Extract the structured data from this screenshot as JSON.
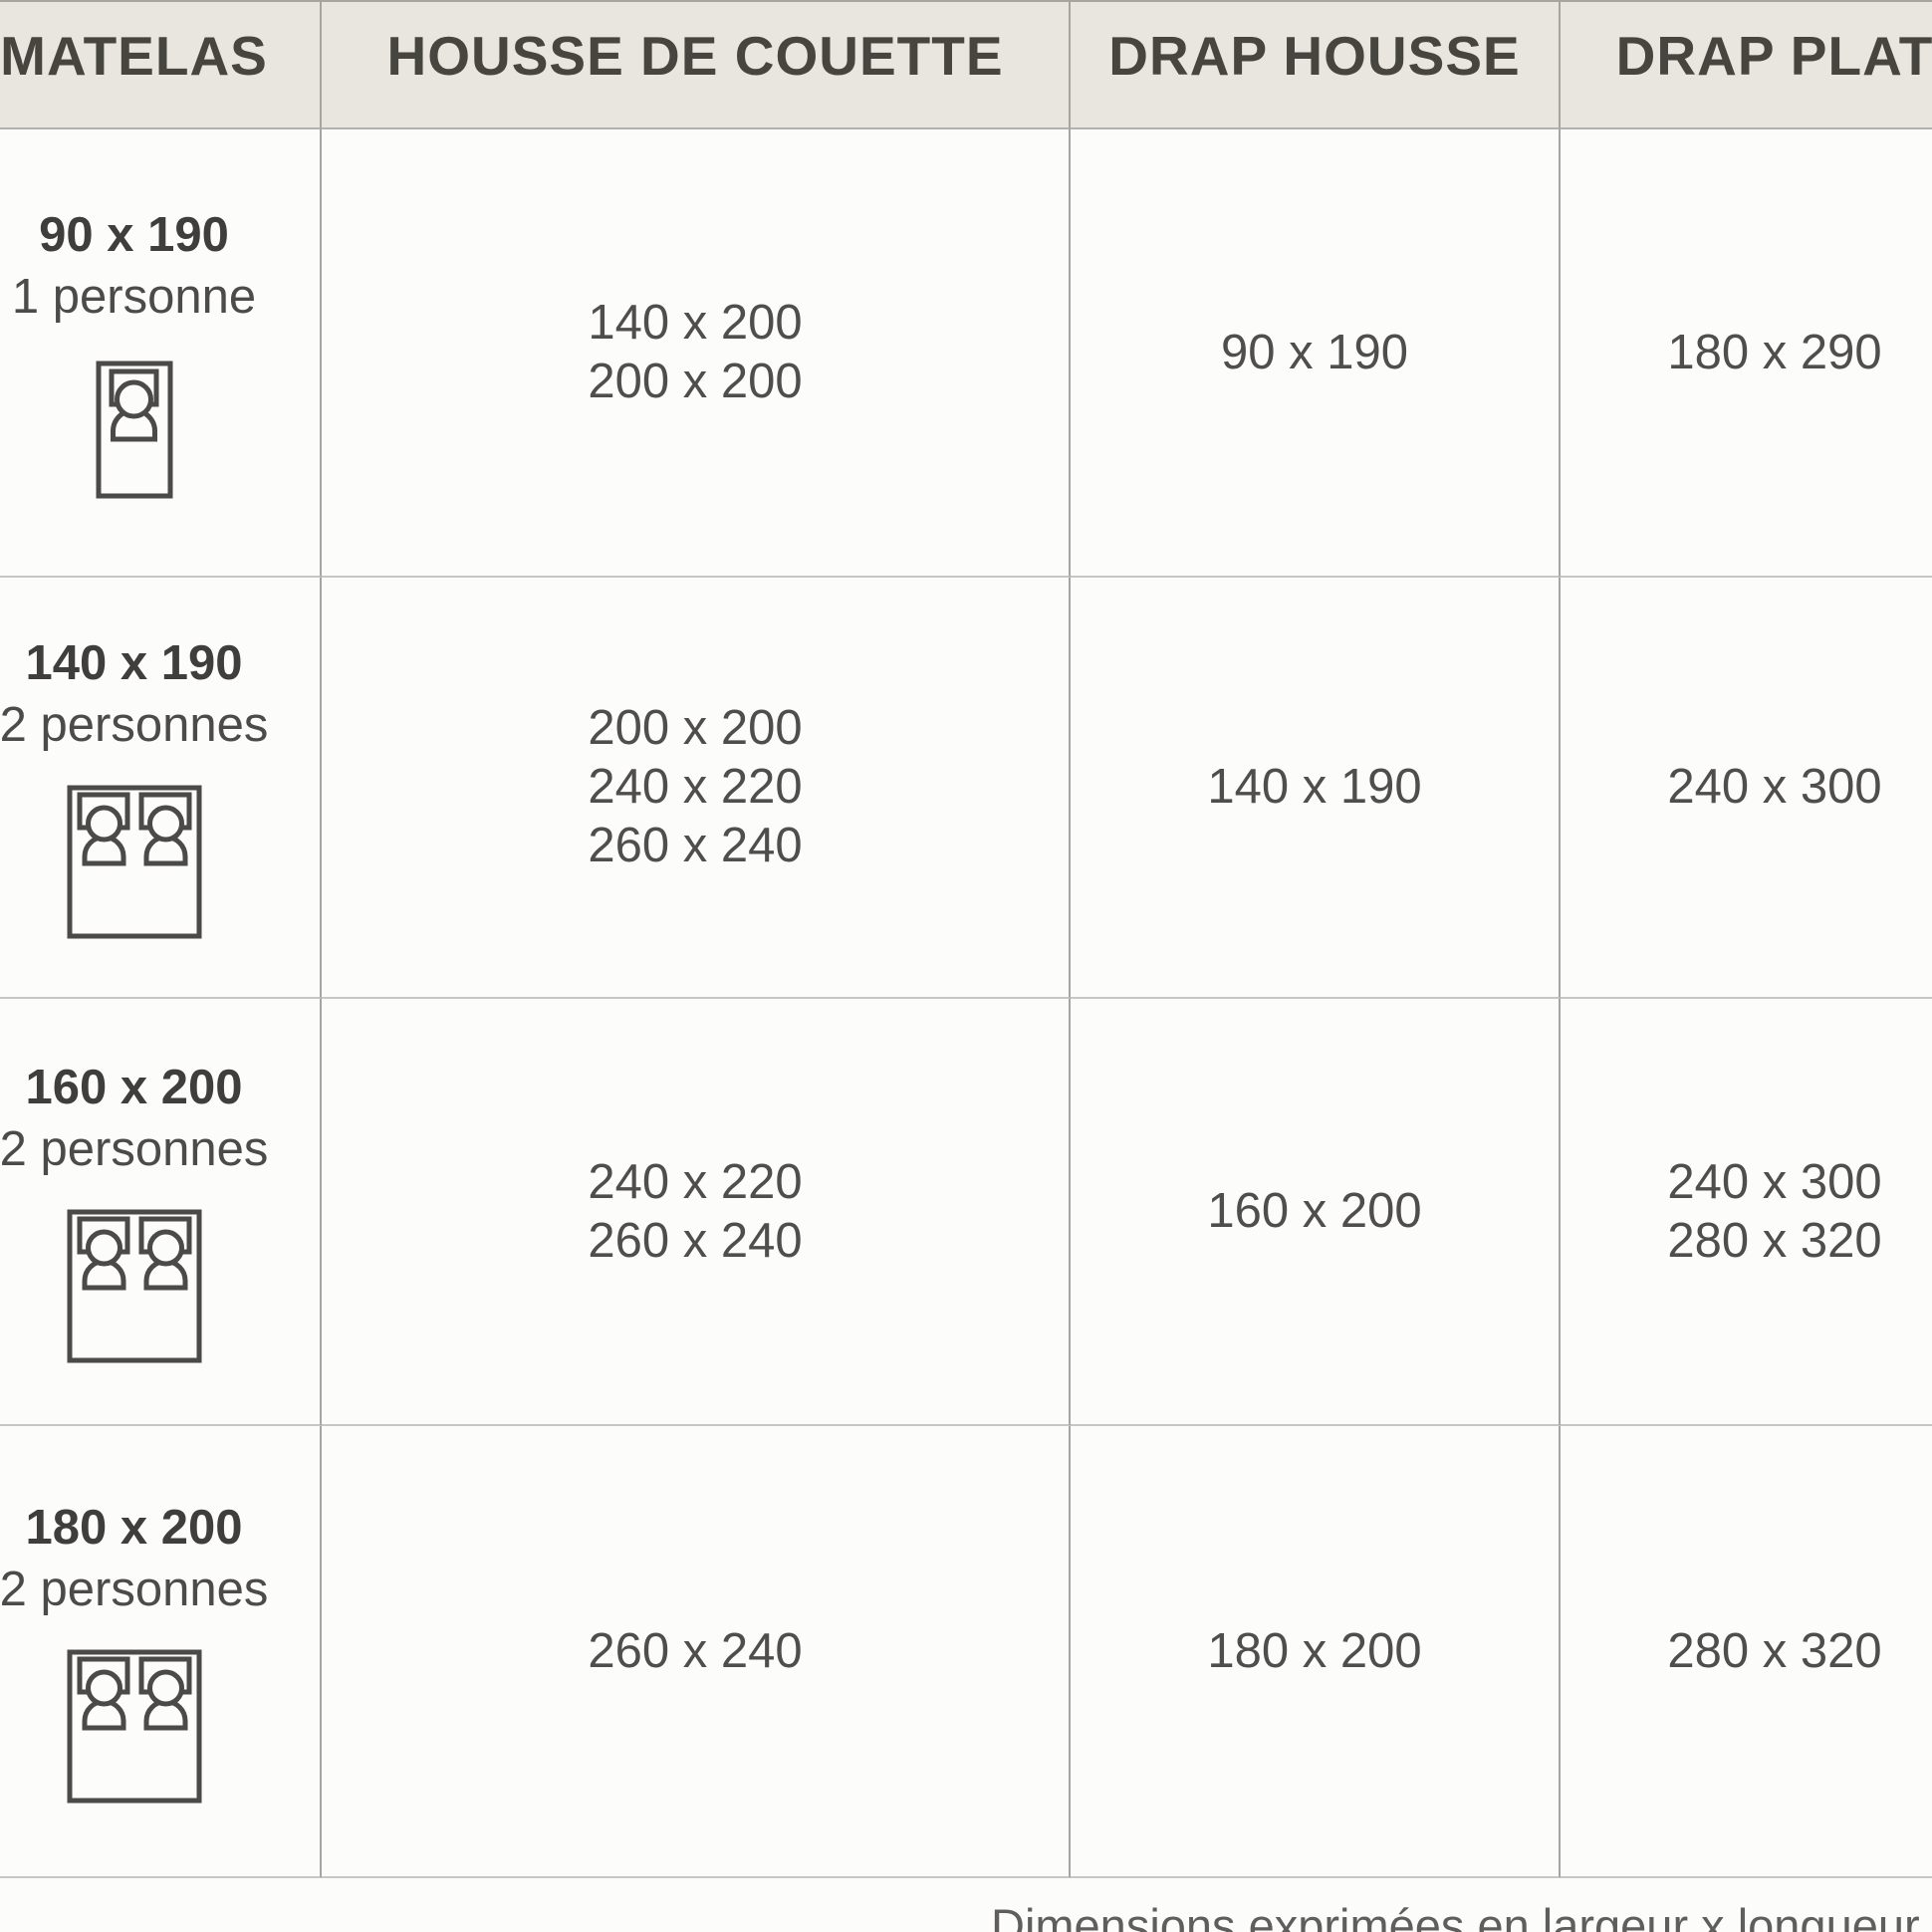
{
  "table": {
    "columns": [
      {
        "label": "MATELAS"
      },
      {
        "label": "HOUSSE DE COUETTE"
      },
      {
        "label": "DRAP HOUSSE"
      },
      {
        "label": "DRAP PLAT"
      }
    ],
    "rows": [
      {
        "matelas_size": "90 x 190",
        "persons": "1 personne",
        "icon": "single-bed-icon",
        "housse_de_couette": [
          "140 x 200",
          "200 x 200"
        ],
        "drap_housse": [
          "90 x 190"
        ],
        "drap_plat": [
          "180 x 290"
        ]
      },
      {
        "matelas_size": "140 x 190",
        "persons": "2 personnes",
        "icon": "double-bed-icon",
        "housse_de_couette": [
          "200 x 200",
          "240 x 220",
          "260 x 240"
        ],
        "drap_housse": [
          "140 x 190"
        ],
        "drap_plat": [
          "240 x 300"
        ]
      },
      {
        "matelas_size": "160 x 200",
        "persons": "2 personnes",
        "icon": "double-bed-icon",
        "housse_de_couette": [
          "240 x 220",
          "260 x 240"
        ],
        "drap_housse": [
          "160 x 200"
        ],
        "drap_plat": [
          "240 x 300",
          "280 x 320"
        ]
      },
      {
        "matelas_size": "180 x 200",
        "persons": "2 personnes",
        "icon": "double-bed-icon",
        "housse_de_couette": [
          "260 x 240"
        ],
        "drap_housse": [
          "180 x 200"
        ],
        "drap_plat": [
          "280 x 320"
        ]
      }
    ],
    "footer_note": "Dimensions exprimées en largeur x longueur (cm"
  },
  "colors": {
    "header_bg": "#e9e6df",
    "header_text": "#474540",
    "value_text": "#4f4e4c",
    "vertical_line": "#a7a5a1",
    "horizontal_line": "#c8c6c2",
    "icon_stroke": "#4c4a47"
  }
}
